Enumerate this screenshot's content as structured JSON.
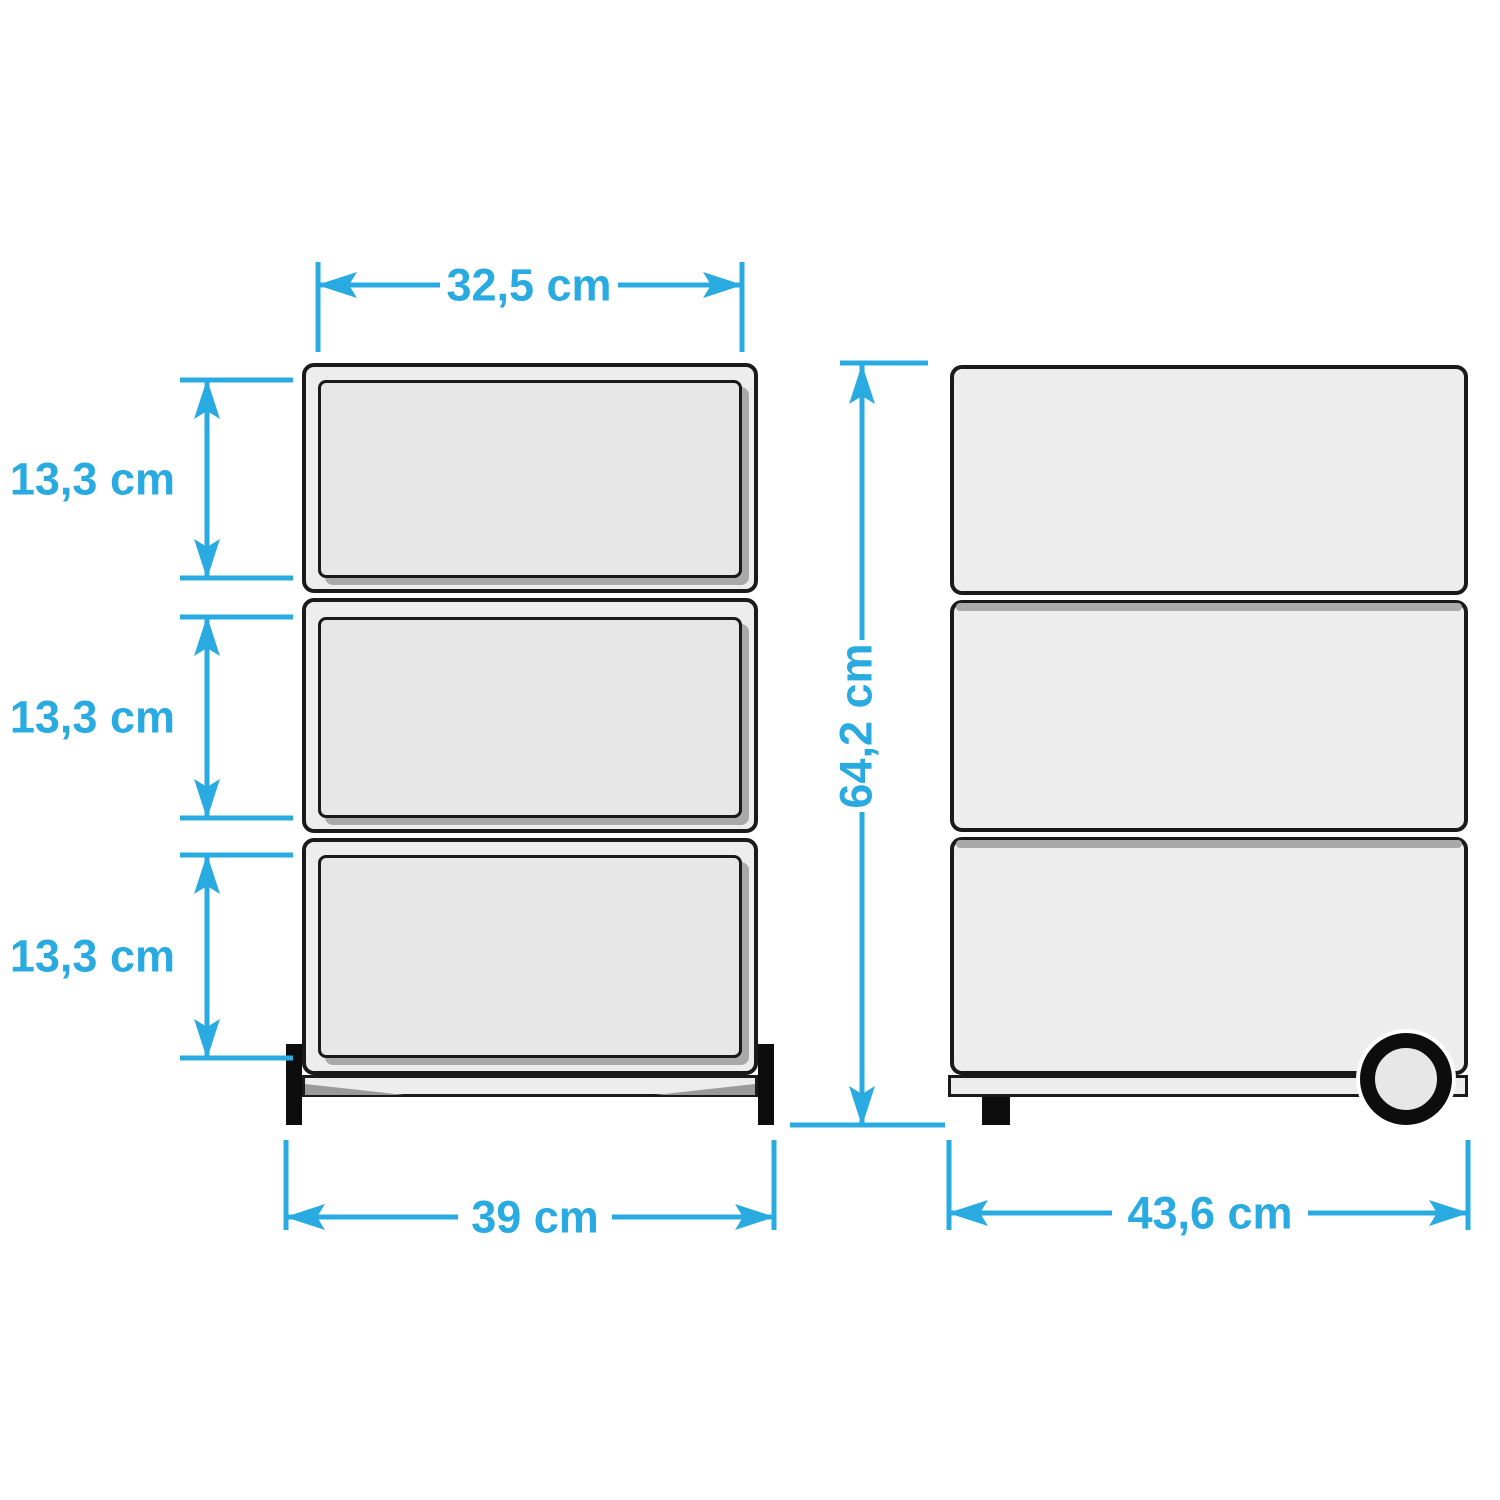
{
  "colors": {
    "accent": "#29ABE2",
    "outline": "#1a1a1a",
    "cabinet_fill": "#ededed",
    "drawer_fill": "#e7e7e7",
    "shadow": "#a9a9a9",
    "foot": "#0d0d0d"
  },
  "front_view": {
    "drawer_count": 3,
    "dim_drawer_width": "32,5 cm",
    "dim_drawer_heights": [
      "13,3 cm",
      "13,3 cm",
      "13,3 cm"
    ],
    "dim_total_width": "39 cm"
  },
  "side_view": {
    "dim_total_height": "64,2 cm",
    "dim_total_depth": "43,6 cm"
  }
}
